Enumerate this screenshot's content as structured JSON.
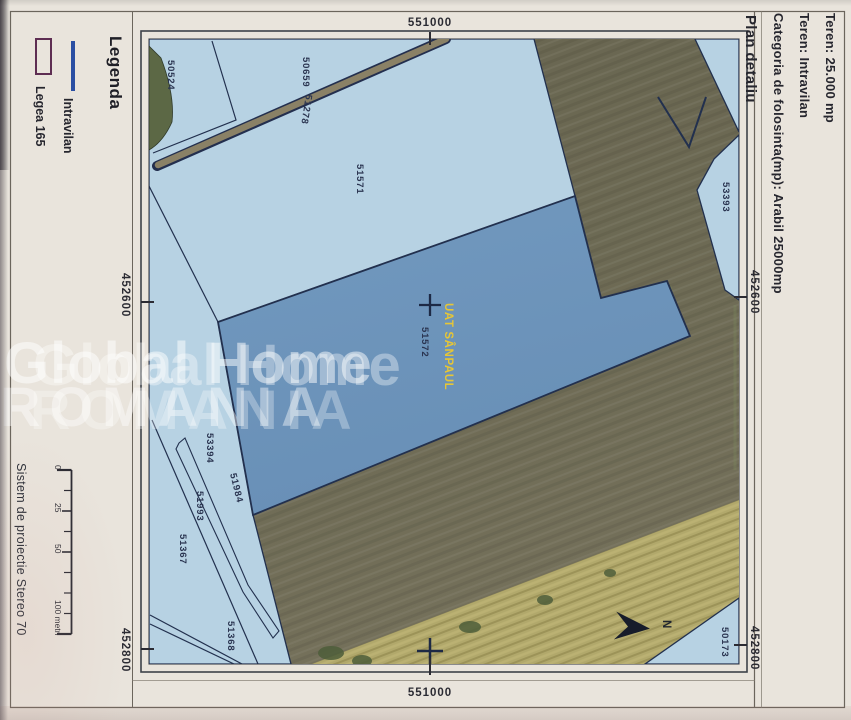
{
  "title_block": {
    "line1": "Teren:  25.000 mp",
    "line2": "Teren: Intravilan",
    "line3": "Categoria de folosinta(mp): Arabil 25000mp",
    "line4": "Plan detaliu"
  },
  "legend": {
    "heading": "Legenda",
    "item1_label": "Intravilan",
    "item2_label": "Legea 165"
  },
  "projection": "Sistem de proiectie Stereo 70",
  "scalebar": {
    "t0": "0",
    "t25": "25",
    "t50": "50",
    "t100": "100 metri"
  },
  "grid": {
    "top": "551000",
    "bottom": "551000",
    "left_upper": "452600",
    "left_lower": "452800",
    "right_upper": "452600",
    "right_lower": "452800"
  },
  "map": {
    "uat_label": "UAT SÂNPAUL",
    "north": "N",
    "parcels": {
      "p50524": "50524",
      "p50659": "50659",
      "p51278": "51278",
      "p51571": "51571",
      "p51572": "51572",
      "p53393": "53393",
      "p53394": "53394",
      "p51984": "51984",
      "p51993": "51993",
      "p51367": "51367",
      "p51368": "51368",
      "p50173": "50173"
    }
  },
  "watermark": {
    "line1": "Global Home",
    "line2": "ROMANIA"
  },
  "colors": {
    "paper": "#e9e4dc",
    "light_blue_parcel": "#b7d2e3",
    "subject_parcel_blue": "#6f96bd",
    "field_olive": "#6b6852",
    "field_yellow": "#b1a86b",
    "outline_navy": "#22304e",
    "uat_yellow": "#e6c636",
    "legend_line_blue": "#2b4fa3",
    "legend_rect_border": "#5e2d52"
  }
}
